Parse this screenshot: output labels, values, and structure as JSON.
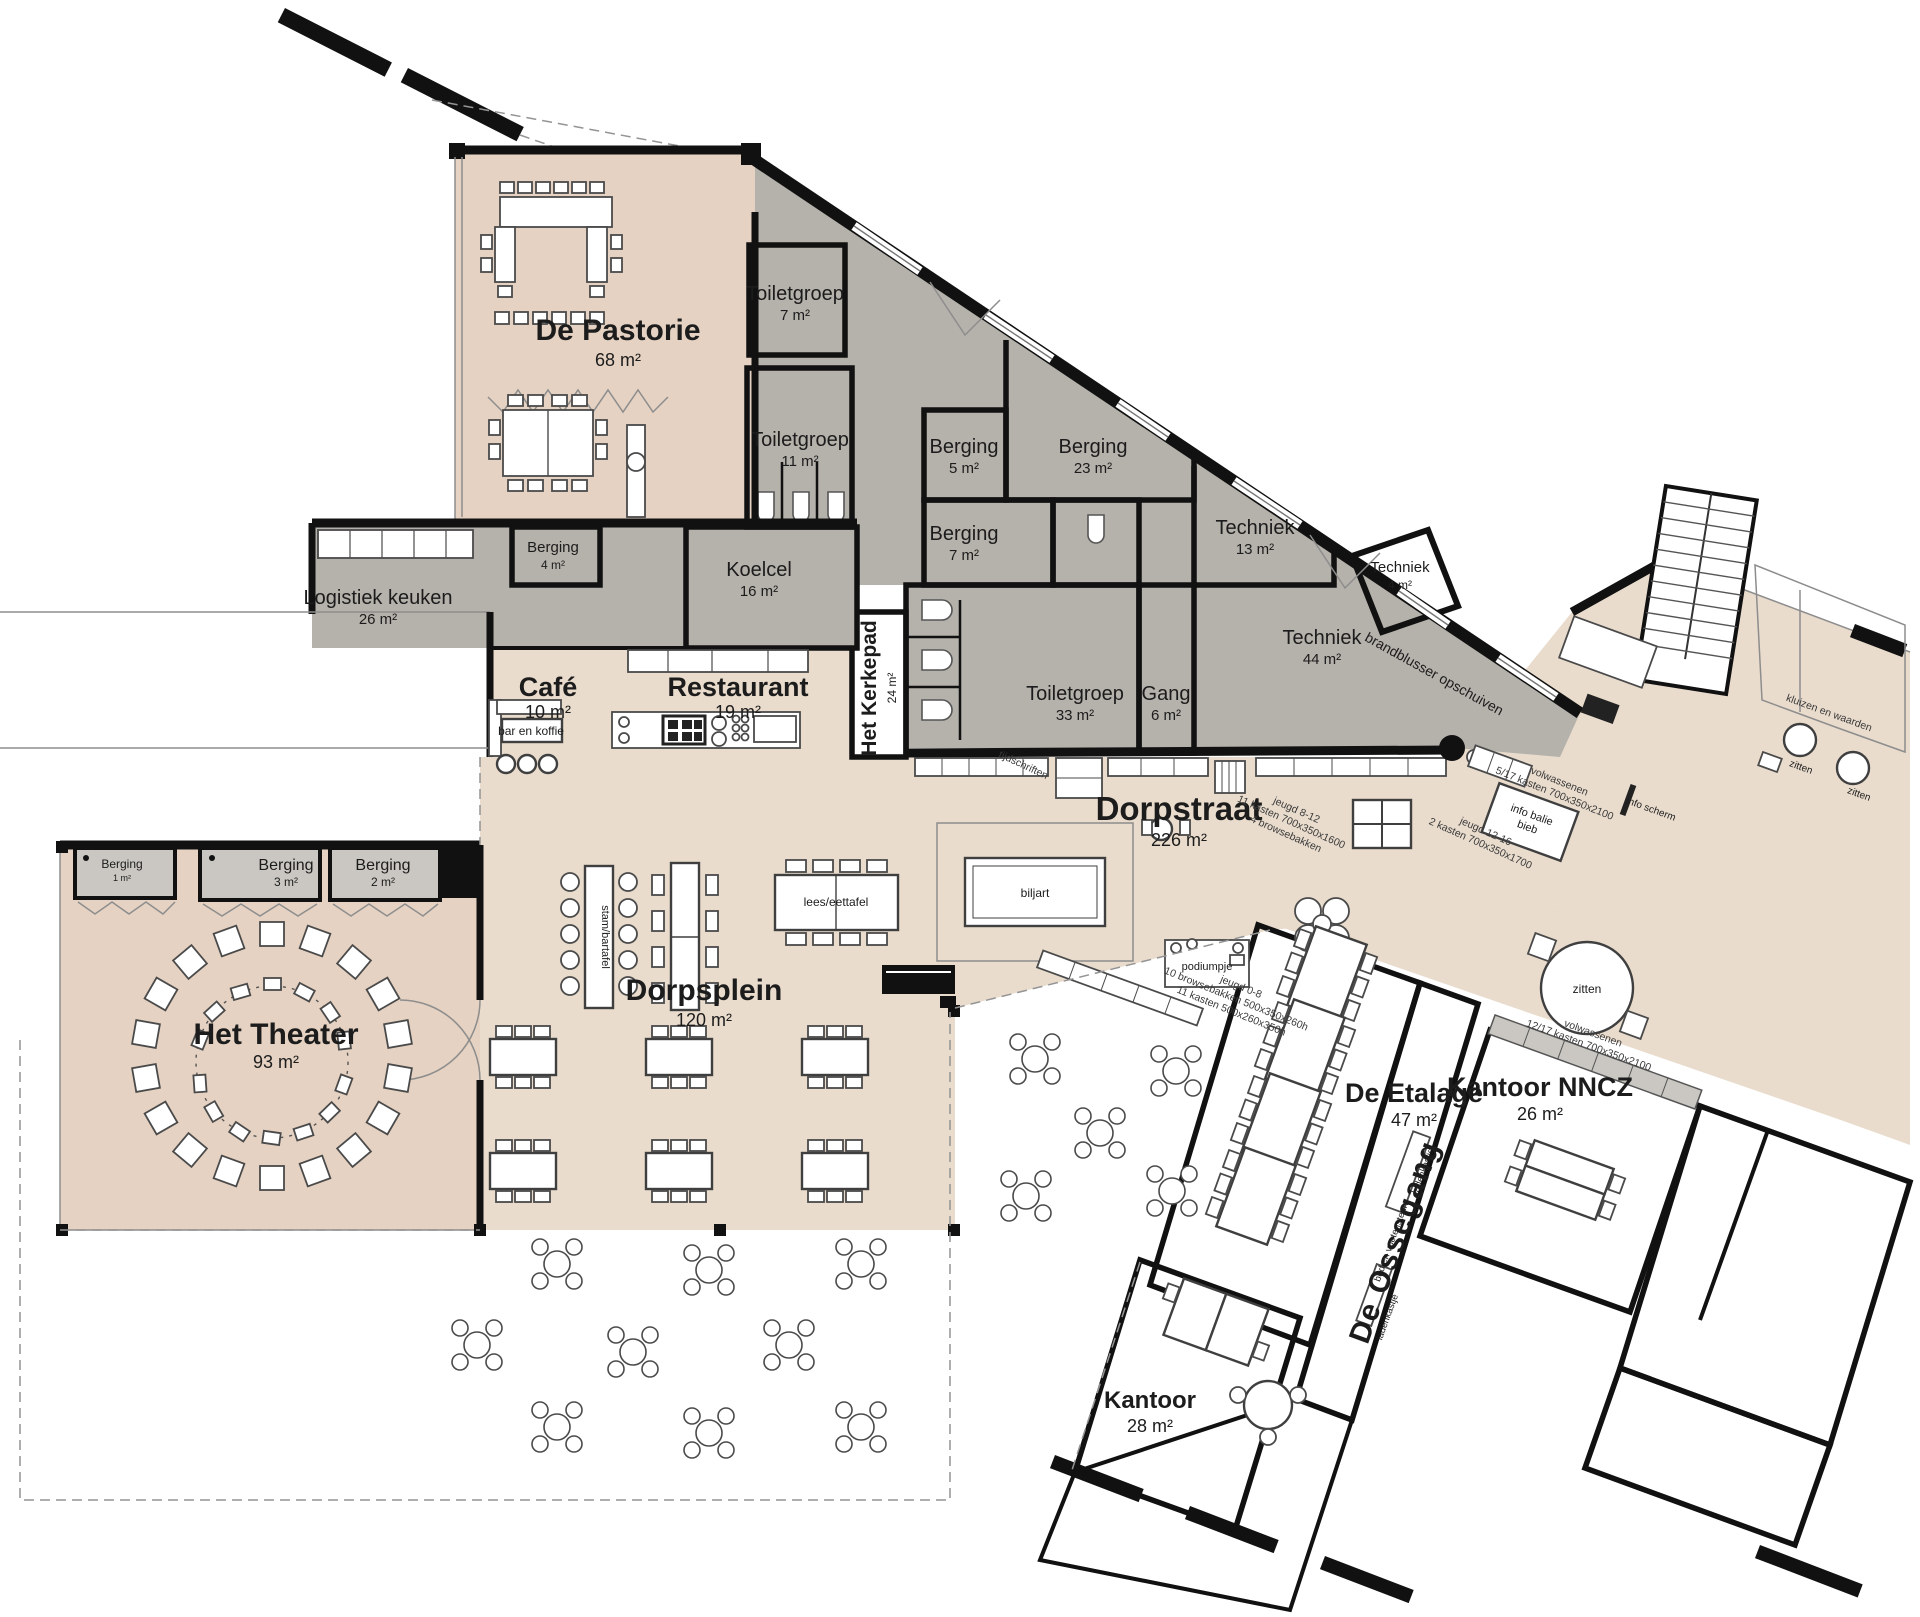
{
  "colors": {
    "tan": "#e9dccd",
    "tan_dark": "#e5d2c2",
    "etalage": "#d9c2b1",
    "gray": "#b5b1ab",
    "gray_light": "#cac7c2",
    "olive": "#dcd8b4",
    "wall": "#111111"
  },
  "rooms": {
    "pastorie": {
      "name": "De Pastorie",
      "area": "68 m²"
    },
    "toiletgroep7": {
      "name": "Toiletgroep",
      "area": "7 m²"
    },
    "toiletgroep11": {
      "name": "Toiletgroep",
      "area": "11 m²"
    },
    "berging5": {
      "name": "Berging",
      "area": "5 m²"
    },
    "berging23": {
      "name": "Berging",
      "area": "23 m²"
    },
    "berging4": {
      "name": "Berging",
      "area": "4 m²"
    },
    "berging7": {
      "name": "Berging",
      "area": "7 m²"
    },
    "koelcel": {
      "name": "Koelcel",
      "area": "16 m²"
    },
    "logistiek": {
      "name": "Logistiek keuken",
      "area": "26 m²"
    },
    "techniek13": {
      "name": "Techniek",
      "area": "13 m²"
    },
    "techniek4": {
      "name": "Techniek",
      "area": "4 m²"
    },
    "techniek44": {
      "name": "Techniek",
      "area": "44 m²"
    },
    "cafe": {
      "name": "Café",
      "area": "10 m²"
    },
    "restaurant": {
      "name": "Restaurant",
      "area": "19 m²"
    },
    "kerkepad": {
      "name": "Het Kerkepad",
      "area": "24 m²"
    },
    "toiletgroep33": {
      "name": "Toiletgroep",
      "area": "33 m²"
    },
    "gang": {
      "name": "Gang",
      "area": "6 m²"
    },
    "dorpstraat": {
      "name": "Dorpstraat",
      "area": "226 m²"
    },
    "berging1": {
      "name": "Berging",
      "area": "1 m²"
    },
    "berging3": {
      "name": "Berging",
      "area": "3 m²"
    },
    "berging2": {
      "name": "Berging",
      "area": "2 m²"
    },
    "theater": {
      "name": "Het Theater",
      "area": "93 m²"
    },
    "dorpsplein": {
      "name": "Dorpsplein",
      "area": "120 m²"
    },
    "etalage": {
      "name": "De Etalage",
      "area": "47 m²"
    },
    "kantoor_nncz": {
      "name": "Kantoor NNCZ",
      "area": "26 m²"
    },
    "kantoor": {
      "name": "Kantoor",
      "area": "28 m²"
    },
    "ossegang": {
      "name": "De Ossegang"
    }
  },
  "furniture": {
    "bar_en_koffie": "bar en koffie",
    "biljart": "biljart",
    "podiumpje": "podiumpje",
    "stam_bartafel": "stam/bartafel",
    "lees_eettafel": "lees/eettafel",
    "info_balie_1": "info balie",
    "info_balie_2": "bieb",
    "info_scherm": "info scherm",
    "zitten": "zitten",
    "ladenkastje": "ladenkastje",
    "bed_voetensteun": "bed en voetensteun"
  },
  "annotations": {
    "tijdschriften": "tijdschriften",
    "brandblusser": "brandblusser opschuiven",
    "jeugd812_1": "jeugd 8-12",
    "jeugd812_2": "11 kasten 700x350x1600",
    "jeugd812_3": "4 browsebakken",
    "jeugd1216_1": "jeugd 12-16",
    "jeugd1216_2": "2 kasten 700x350x1700",
    "volw_a_1": "volwassenen",
    "volw_a_2": "5/17 kasten 700x350x2100",
    "volw_b_1": "volwassenen",
    "volw_b_2": "12/17 kasten 700x350x2100",
    "jeugd08_1": "jeugd 0-8",
    "jeugd08_2": "10 browsebakken 500x350x260h",
    "jeugd08_3": "11 kasten 500x260x350h",
    "kluizen": "kluizen en waarden"
  }
}
